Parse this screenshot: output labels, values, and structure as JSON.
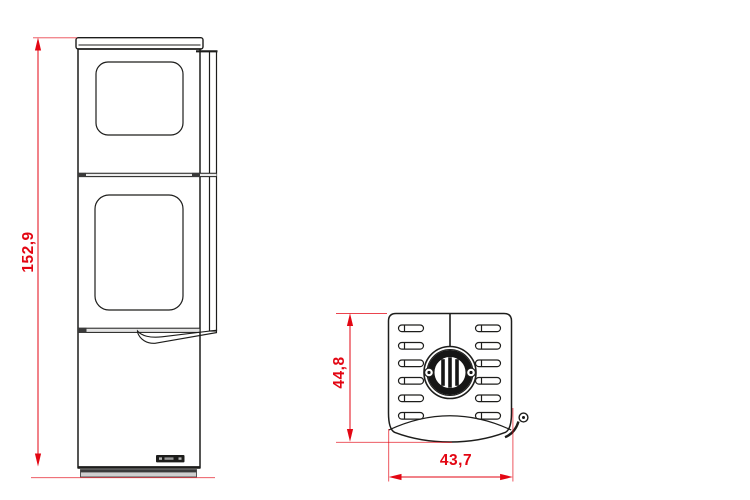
{
  "colors": {
    "dimension_red": "#e30613",
    "line_black": "#1d1d1b",
    "background": "#ffffff"
  },
  "dimensions": {
    "front_height": {
      "value": "152,9"
    },
    "top_depth": {
      "value": "44,8"
    },
    "top_width": {
      "value": "43,7"
    }
  }
}
